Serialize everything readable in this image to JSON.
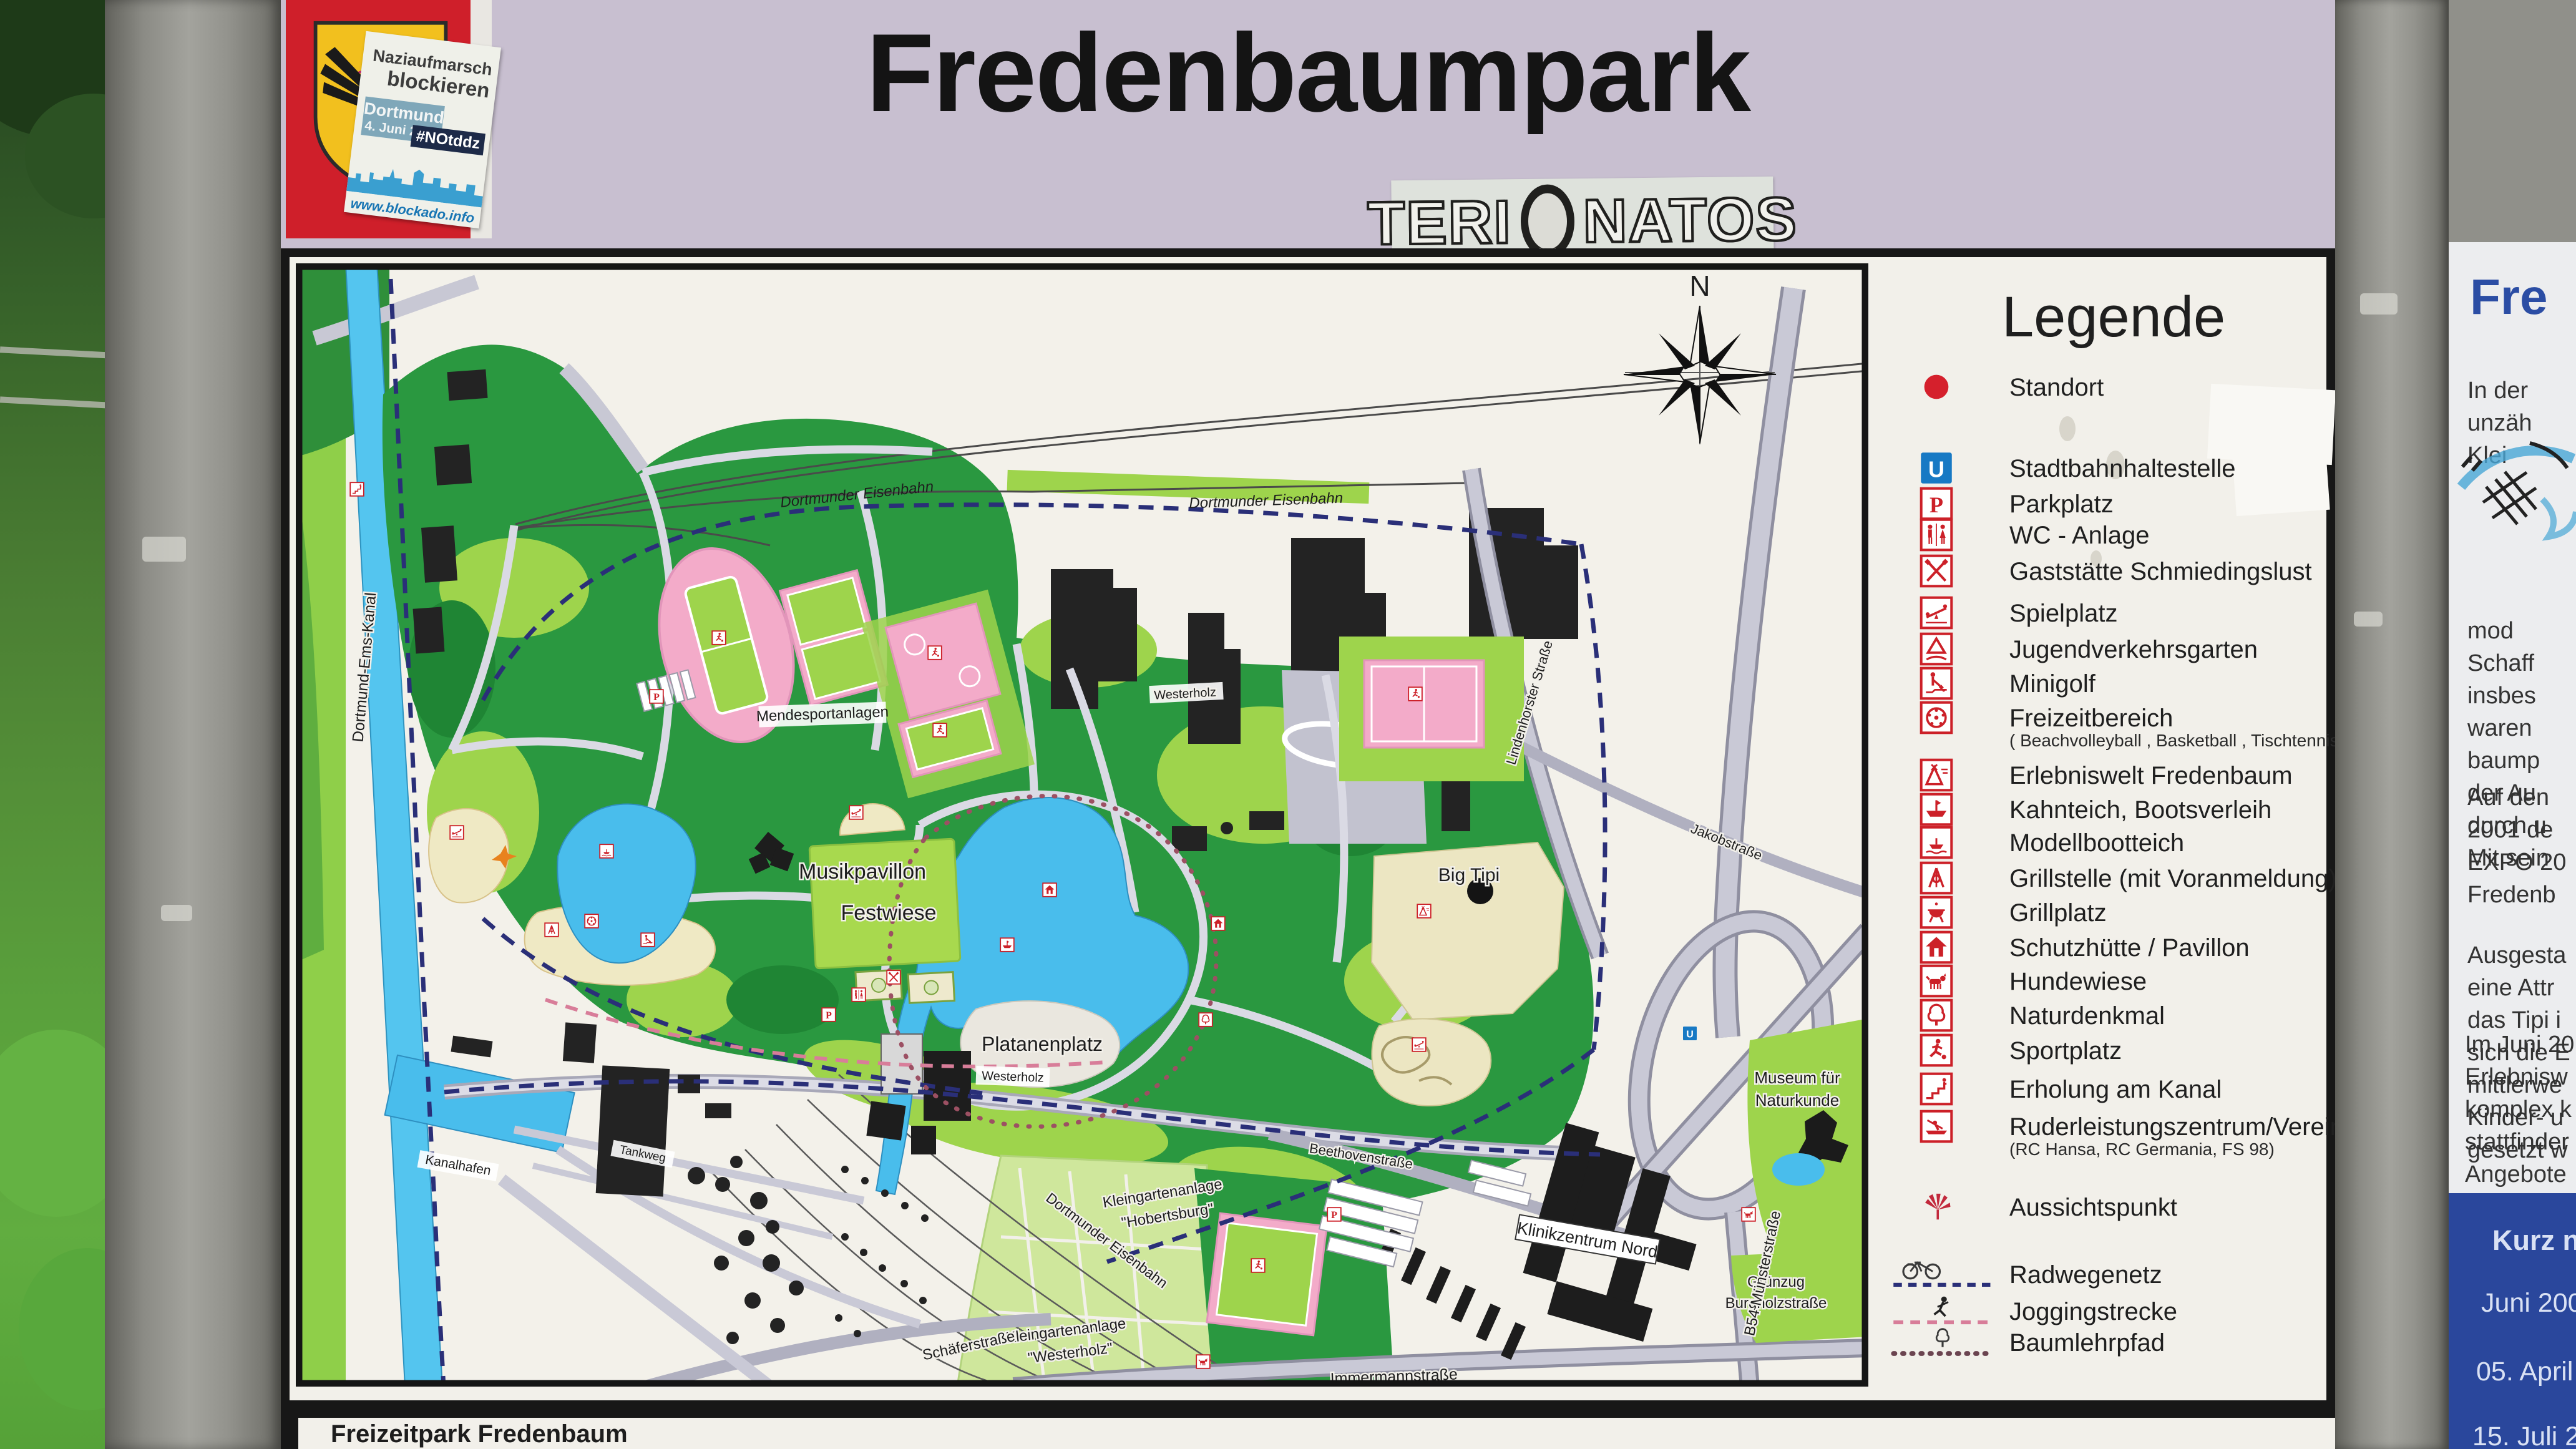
{
  "header": {
    "title": "Fredenbaumpark",
    "blockado_sticker": {
      "line1": "Naziaufmarsch",
      "line2": "blockieren",
      "bubble_line1": "Dortmund",
      "bubble_line2": "4. Juni 2016",
      "hashtag": "#NOtddz",
      "url": "www.blockado.info"
    },
    "graffiti_sticker": {
      "left": "TERI",
      "right": "NATOS",
      "badge_year": "2011"
    }
  },
  "map": {
    "caption": "Freizeitpark Fredenbaum",
    "labels": [
      "Dortmund-Ems-Kanal",
      "Dortmunder Eisenbahn",
      "Dortmunder Eisenbahn",
      "Mendesportanlagen",
      "Musikpavillon",
      "Festwiese",
      "Platanenplatz",
      "Westerholz",
      "Big Tipi",
      "Kleingartenanlage",
      "\"Hobertsburg\"",
      "Kleingartenanlage",
      "\"Westerholz\"",
      "Klinikzentrum Nord",
      "Museum für",
      "Naturkunde",
      "Grünzug",
      "Burgholzstraße",
      "Immermannstraße",
      "Schäferstraße",
      "B54 Münsterstraße",
      "Beethovenstraße",
      "N",
      "Dortmunder Eisenbahn",
      "Kanalhafen",
      "Tankweg",
      "Jakobstraße",
      "Lindenhorster Straße",
      "Westerholz"
    ]
  },
  "legend": {
    "title": "Legende",
    "items": [
      {
        "icon": "standort-dot",
        "label": "Standort"
      },
      {
        "icon": "stadtbahn-u",
        "label": "Stadtbahnhaltestelle"
      },
      {
        "icon": "parkplatz-p",
        "label": "Parkplatz"
      },
      {
        "icon": "wc",
        "label": "WC - Anlage"
      },
      {
        "icon": "gaststaette",
        "label": "Gaststätte Schmiedingslust"
      },
      {
        "icon": "spielplatz",
        "label": "Spielplatz"
      },
      {
        "icon": "jugendverkehrsgarten",
        "label": "Jugendverkehrsgarten"
      },
      {
        "icon": "minigolf",
        "label": "Minigolf"
      },
      {
        "icon": "freizeitbereich",
        "label": "Freizeitbereich",
        "sublabel": "( Beachvolleyball , Basketball , Tischtennis )"
      },
      {
        "icon": "erlebniswelt",
        "label": "Erlebniswelt Fredenbaum"
      },
      {
        "icon": "kahnteich",
        "label": "Kahnteich, Bootsverleih"
      },
      {
        "icon": "modellboot",
        "label": "Modellbootteich"
      },
      {
        "icon": "grillstelle",
        "label": "Grillstelle (mit Voranmeldung)"
      },
      {
        "icon": "grillplatz",
        "label": "Grillplatz"
      },
      {
        "icon": "schutzhuette",
        "label": "Schutzhütte / Pavillon"
      },
      {
        "icon": "hundewiese",
        "label": "Hundewiese"
      },
      {
        "icon": "naturdenkmal",
        "label": "Naturdenkmal"
      },
      {
        "icon": "sportplatz",
        "label": "Sportplatz"
      },
      {
        "icon": "erholung-kanal",
        "label": "Erholung am Kanal"
      },
      {
        "icon": "ruderzentrum",
        "label": "Ruderleistungszentrum/Vereine",
        "sublabel": "(RC Hansa, RC Germania, FS 98)"
      },
      {
        "icon": "aussichtspunkt",
        "label": "Aussichtspunkt"
      },
      {
        "icon": "radweg",
        "label": "Radwegenetz"
      },
      {
        "icon": "jogging",
        "label": "Joggingstrecke"
      },
      {
        "icon": "baumlehrpfad",
        "label": "Baumlehrpfad"
      }
    ]
  },
  "right_sign": {
    "title": "Fre",
    "paragraphs": [
      [
        "In der",
        "unzäh",
        "Klei"
      ],
      [
        "mod",
        "Schaff",
        "insbes",
        "waren",
        "baump",
        "der Au",
        "durch u",
        "Mit sein"
      ],
      [
        "Auf den",
        "2001 de",
        "EXPO 20",
        "Fredenb"
      ],
      [
        "Ausgesta",
        "eine Attr",
        "das Tipi i",
        "sich die E",
        "mittlerwe",
        "Kinder- u",
        "gesetzt w"
      ],
      [
        "Im Juni 20",
        "Erlebnisw",
        "komplex k",
        "stattfinder",
        "Angebote"
      ]
    ],
    "notice": {
      "title": "Kurz notier",
      "entries": [
        "Juni 2005 -",
        "05. April 20",
        "15. Juli 2004"
      ]
    }
  },
  "colors": {
    "header_bg": "#c8bfd0",
    "park_green": "#2a9840",
    "light_green": "#9ed44c",
    "water": "#49bdec",
    "field_pink": "#f3abc9",
    "icon_red": "#cc2028",
    "stadtbahn_blue": "#1779c4",
    "notice_blue": "#2a479c"
  }
}
